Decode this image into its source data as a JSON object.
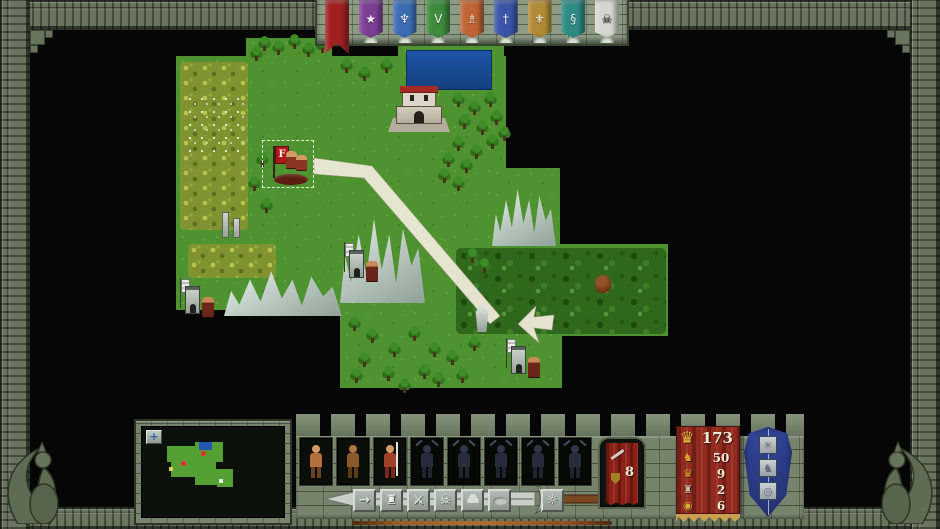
{
  "top_banner_bar": {
    "banners": [
      {
        "name": "banner-red-crusader",
        "color": "#a02020",
        "glyph": "",
        "pattern": "cross",
        "active": true
      },
      {
        "name": "banner-purple-star",
        "color": "#7c3f94",
        "glyph": "★"
      },
      {
        "name": "banner-blue-halberd",
        "color": "#3c6cb4",
        "glyph": "♆"
      },
      {
        "name": "banner-green-chevron",
        "color": "#3c8c3c",
        "glyph": "V"
      },
      {
        "name": "banner-orange-keeper",
        "color": "#c06434",
        "glyph": "♗"
      },
      {
        "name": "banner-navy-cross",
        "color": "#3a55a8",
        "glyph": "†"
      },
      {
        "name": "banner-gold-eagle",
        "color": "#b08a34",
        "glyph": "⚜"
      },
      {
        "name": "banner-teal-serpent",
        "color": "#2c8c84",
        "glyph": "§"
      },
      {
        "name": "banner-white-skull",
        "color": "#d6d6d2",
        "glyph": "☠",
        "dark_glyph": true
      }
    ]
  },
  "map": {
    "hero_flag_letter": "F",
    "grass_blocks": [
      [
        246,
        38,
        86,
        26
      ],
      [
        176,
        56,
        330,
        254
      ],
      [
        398,
        46,
        106,
        50
      ],
      [
        490,
        168,
        70,
        82
      ],
      [
        440,
        244,
        228,
        92
      ],
      [
        340,
        308,
        222,
        80
      ]
    ],
    "water_block": [
      406,
      50,
      86,
      40
    ],
    "yellow_forest_blocks": [
      [
        180,
        62,
        68,
        168
      ],
      [
        188,
        244,
        88,
        34
      ]
    ],
    "birch_block": [
      186,
      94,
      58,
      58
    ],
    "dark_forest_blocks": [
      [
        456,
        248,
        210,
        86
      ]
    ],
    "mountain_blocks": [
      [
        224,
        264,
        118,
        52
      ],
      [
        340,
        205,
        85,
        98
      ],
      [
        492,
        180,
        64,
        66
      ]
    ],
    "ruin_block": [
      220,
      210,
      24,
      30
    ],
    "castle": {
      "x": 388,
      "y": 86,
      "w": 62,
      "h": 46
    },
    "trees": [
      [
        258,
        36
      ],
      [
        272,
        40
      ],
      [
        288,
        34
      ],
      [
        302,
        42
      ],
      [
        316,
        38
      ],
      [
        250,
        46
      ],
      [
        340,
        58
      ],
      [
        358,
        66
      ],
      [
        380,
        58
      ],
      [
        452,
        92
      ],
      [
        468,
        100
      ],
      [
        484,
        92
      ],
      [
        458,
        114
      ],
      [
        476,
        120
      ],
      [
        490,
        110
      ],
      [
        452,
        136
      ],
      [
        470,
        144
      ],
      [
        486,
        134
      ],
      [
        498,
        126
      ],
      [
        442,
        152
      ],
      [
        460,
        158
      ],
      [
        438,
        168
      ],
      [
        452,
        176
      ],
      [
        466,
        248
      ],
      [
        478,
        258
      ],
      [
        348,
        316
      ],
      [
        366,
        328
      ],
      [
        388,
        342
      ],
      [
        358,
        352
      ],
      [
        408,
        326
      ],
      [
        428,
        342
      ],
      [
        350,
        368
      ],
      [
        382,
        366
      ],
      [
        418,
        364
      ],
      [
        446,
        350
      ],
      [
        456,
        368
      ],
      [
        468,
        336
      ],
      [
        432,
        372
      ],
      [
        398,
        378
      ],
      [
        256,
        152
      ],
      [
        248,
        176
      ],
      [
        260,
        198
      ]
    ],
    "units": [
      {
        "name": "selected-hero-army",
        "type": "hero",
        "x": 264,
        "y": 142
      },
      {
        "name": "garrison-tower-a",
        "type": "tower",
        "x": 342,
        "y": 242
      },
      {
        "name": "garrison-tower-b",
        "type": "tower",
        "x": 178,
        "y": 278
      },
      {
        "name": "wraith-stack",
        "type": "wraith",
        "x": 470,
        "y": 304
      },
      {
        "name": "garrison-tower-c",
        "type": "tower",
        "x": 504,
        "y": 338
      },
      {
        "name": "wild-beast",
        "type": "beast",
        "x": 594,
        "y": 274
      }
    ]
  },
  "bottom": {
    "minimap": {
      "button_glyph": "+",
      "land_blocks": [
        [
          25,
          19,
          30,
          16
        ],
        [
          53,
          15,
          28,
          20
        ],
        [
          29,
          32,
          45,
          18
        ],
        [
          53,
          42,
          38,
          16
        ],
        [
          75,
          50,
          16,
          10
        ]
      ],
      "water_block": [
        57,
        15,
        13,
        8
      ],
      "flag_dots": [
        [
          59,
          24
        ],
        [
          39,
          34
        ]
      ],
      "spot_dots": [
        [
          27,
          40,
          "#d8d060"
        ],
        [
          77,
          52,
          "#e8e8e8"
        ]
      ]
    },
    "unit_slots": [
      {
        "name": "army-slot-barbarian",
        "kind": "barbarian",
        "state": "active"
      },
      {
        "name": "army-slot-beastman",
        "kind": "beastman",
        "state": "active"
      },
      {
        "name": "army-slot-spearman",
        "kind": "spearman",
        "state": "active"
      },
      {
        "name": "army-slot-empty-1",
        "kind": "shadow",
        "state": "empty"
      },
      {
        "name": "army-slot-empty-2",
        "kind": "shadow",
        "state": "empty"
      },
      {
        "name": "army-slot-empty-3",
        "kind": "shadow",
        "state": "empty"
      },
      {
        "name": "army-slot-empty-4",
        "kind": "shadow",
        "state": "empty"
      },
      {
        "name": "army-slot-empty-5",
        "kind": "shadow",
        "state": "empty"
      }
    ],
    "action_buttons": [
      {
        "name": "move-button",
        "glyph": "→",
        "gap_before": 0
      },
      {
        "name": "castle-button",
        "glyph": "♜",
        "gap_before": 4
      },
      {
        "name": "attack-button",
        "glyph": "⚔",
        "gap_before": 4
      },
      {
        "name": "disband-button",
        "glyph": "☠",
        "gap_before": 4
      },
      {
        "name": "items-button",
        "shape": "bag",
        "gap_before": 4
      },
      {
        "name": "defend-button",
        "shape": "oval",
        "gap_before": 4
      },
      {
        "name": "lamp-button",
        "glyph": "☼",
        "gap_before": 30
      }
    ],
    "combat_banner": {
      "value": "8"
    },
    "stats_banner": {
      "crown_glyph": "♛",
      "top_value": "173",
      "rows": [
        {
          "icon": "♞",
          "icon_color": "#d8a830",
          "value": "50"
        },
        {
          "icon": "♛",
          "icon_color": "#d8a830",
          "value": "9"
        },
        {
          "icon": "♜",
          "icon_color": "#b8bcb4",
          "value": "2"
        },
        {
          "icon": "◉",
          "icon_color": "#d8b030",
          "value": "6"
        }
      ]
    },
    "magic_shield": {
      "icons": [
        {
          "glyph": "✳"
        },
        {
          "glyph": "♞"
        },
        {
          "glyph": "◎"
        }
      ]
    }
  }
}
